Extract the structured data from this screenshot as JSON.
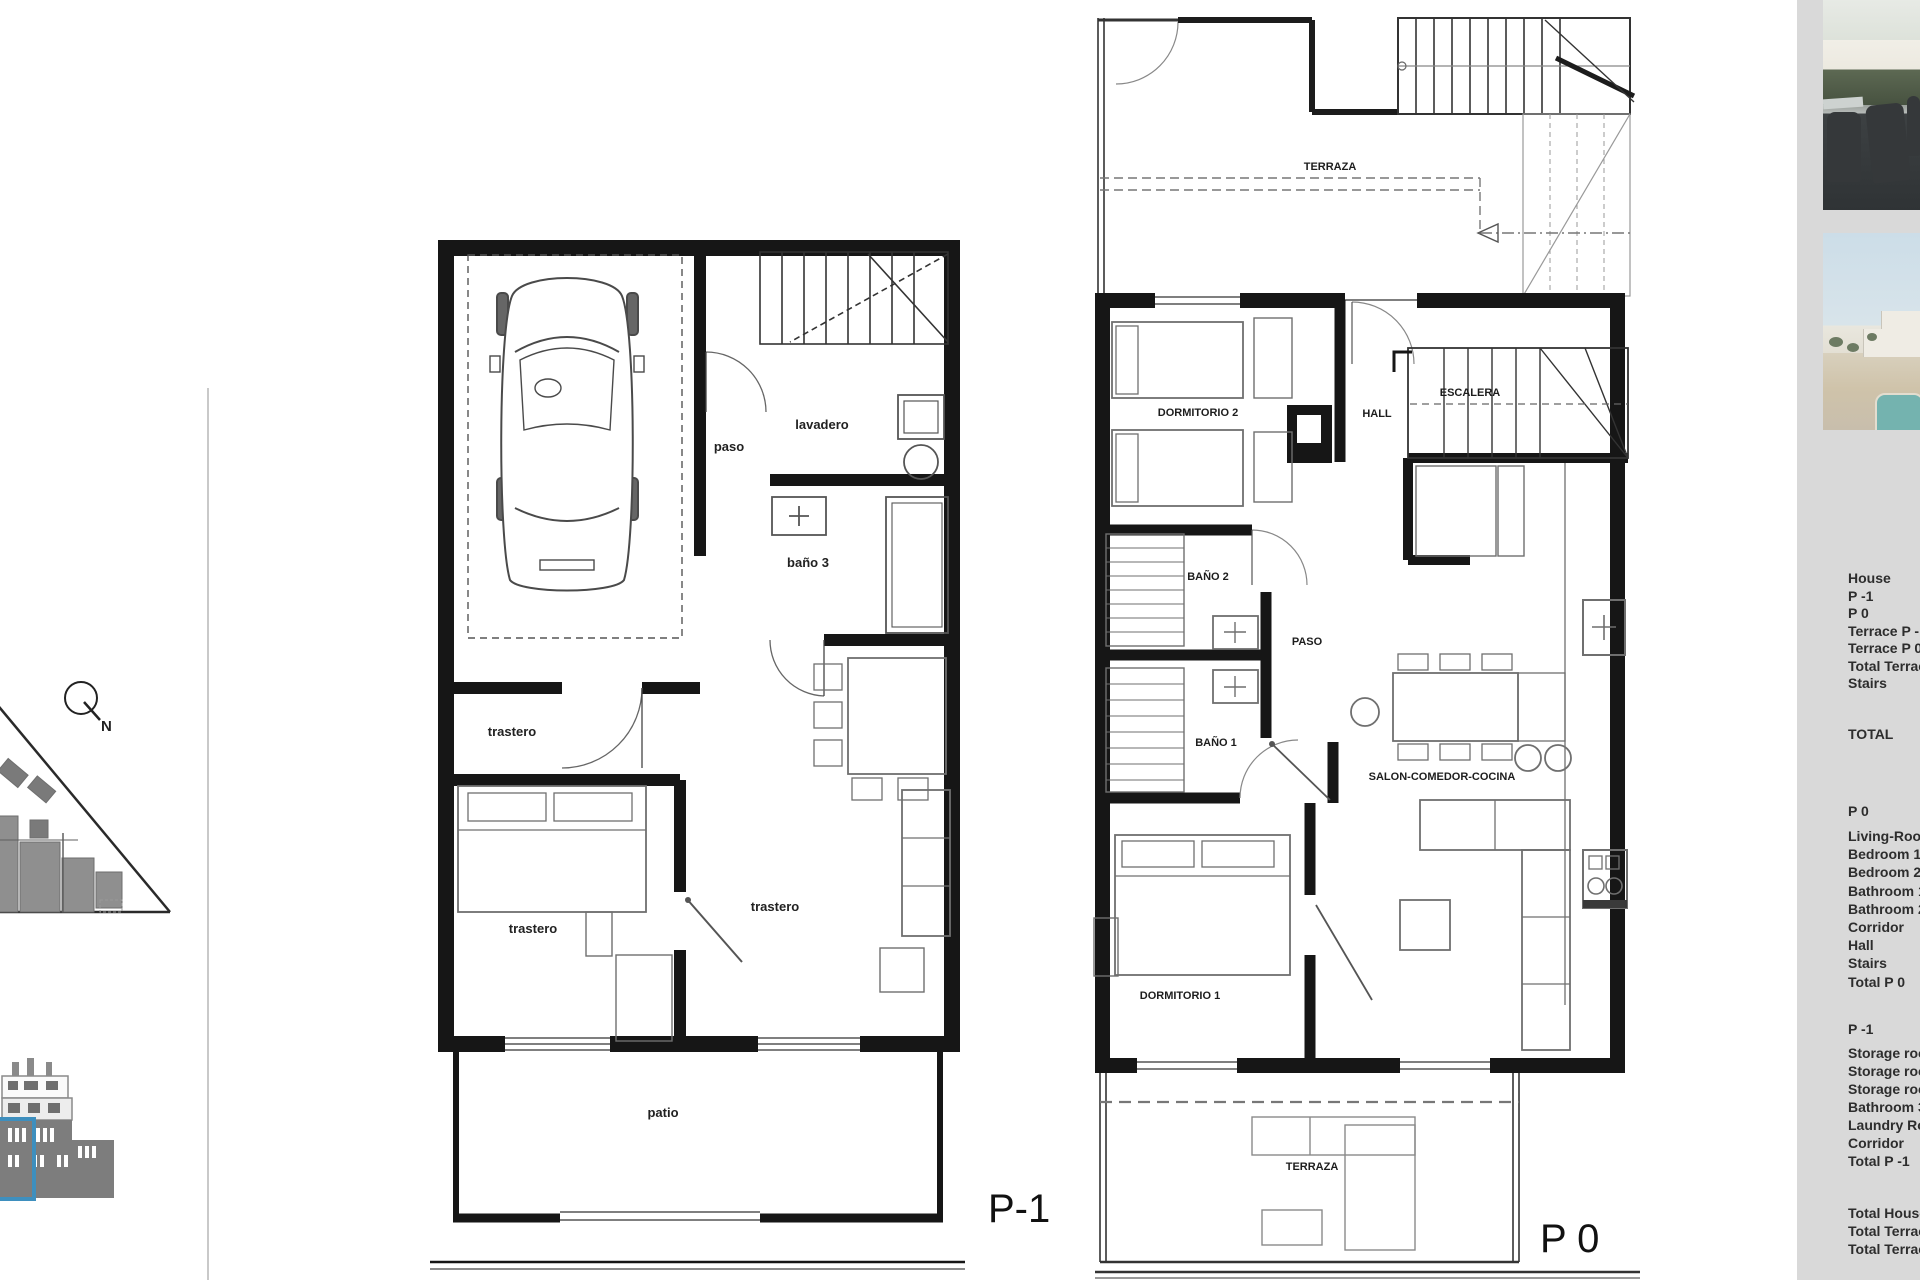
{
  "site_plan": {
    "north_label": "N"
  },
  "plan_p1": {
    "title": "P-1",
    "labels": {
      "paso": "paso",
      "lavadero": "lavadero",
      "bano3": "baño 3",
      "trastero": "trastero",
      "patio": "patio"
    }
  },
  "plan_p0": {
    "title": "P 0",
    "labels": {
      "terraza_top": "TERRAZA",
      "dormitorio2": "DORMITORIO 2",
      "hall": "HALL",
      "escalera": "ESCALERA",
      "bano2": "BAÑO 2",
      "paso": "PASO",
      "bano1": "BAÑO 1",
      "salon": "SALON-COMEDOR-COCINA",
      "dormitorio1": "DORMITORIO 1",
      "terraza_bottom": "TERRAZA"
    }
  },
  "sidebar": {
    "summary": [
      "House",
      "P -1",
      "P 0",
      "Terrace P -1",
      "Terrace P 0",
      "Total Terrace",
      "Stairs"
    ],
    "total_label": "TOTAL",
    "p0_section": {
      "header": "P 0",
      "rooms": [
        "Living-Room",
        "Bedroom 1",
        "Bedroom 2",
        "Bathroom 1",
        "Bathroom 2",
        "Corridor",
        "Hall",
        "Stairs",
        "Total P 0"
      ]
    },
    "p1_section": {
      "header": "P -1",
      "rooms": [
        "Storage room",
        "Storage room",
        "Storage room",
        "Bathroom 3",
        "Laundry Room",
        "Corridor",
        "Total P -1"
      ]
    },
    "totals": [
      "Total House",
      "Total Terrace",
      "Total Terrace"
    ]
  },
  "colors": {
    "highlight_blue": "#3e8fbe",
    "sidebar_bg": "#d9d9d9",
    "wall_black": "#161616",
    "furniture_gray": "#777777"
  }
}
